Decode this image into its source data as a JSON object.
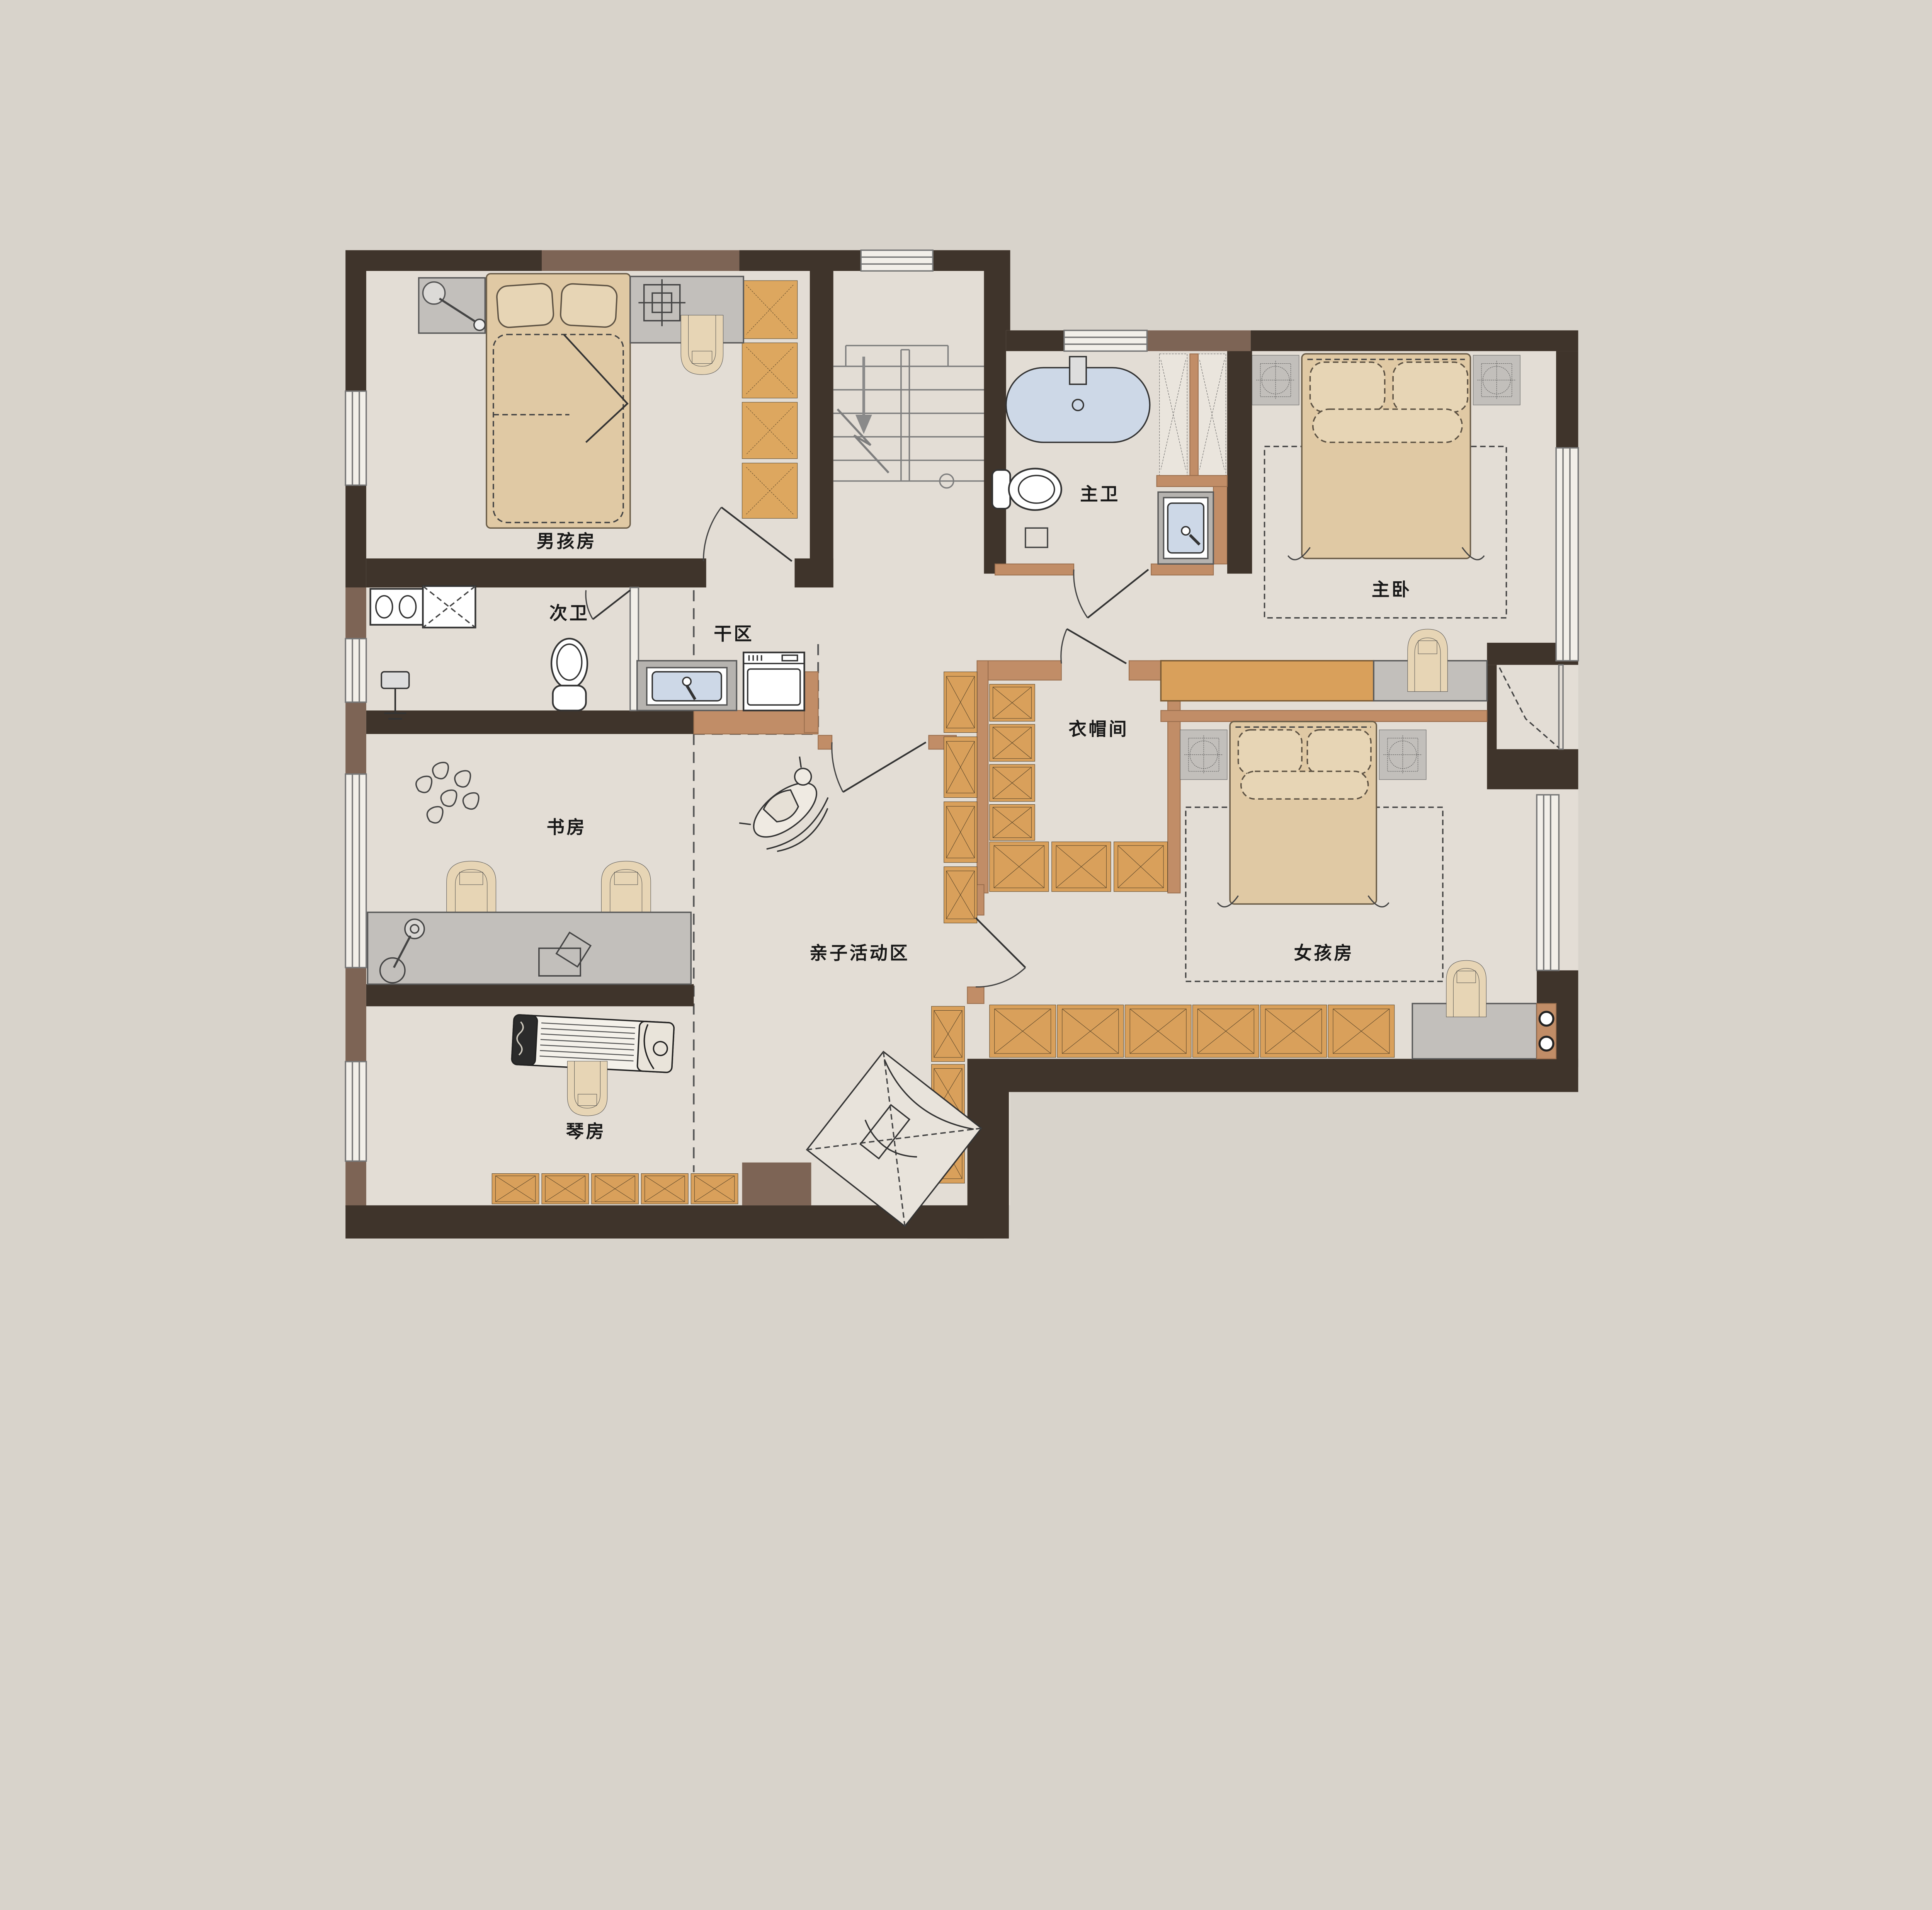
{
  "floorplan": {
    "title": "二层平面布置图",
    "rooms": {
      "boy_room": {
        "label": "男孩房"
      },
      "secondary_bath": {
        "label": "次卫"
      },
      "dry_area": {
        "label": "干区"
      },
      "master_bath": {
        "label": "主卫"
      },
      "master_bedroom": {
        "label": "主卧"
      },
      "walk_in_closet": {
        "label": "衣帽间"
      },
      "study": {
        "label": "书房"
      },
      "activity_area": {
        "label": "亲子活动区"
      },
      "girl_room": {
        "label": "女孩房"
      },
      "piano_room": {
        "label": "琴房"
      }
    },
    "colors": {
      "background": "#d8d3cb",
      "floor": "#e3ddd5",
      "wall_dark": "#3f342b",
      "wall_brown": "#7d6455",
      "wall_tan": "#c18d67",
      "wardrobe_orange": "#d9a05b",
      "water_blue": "#cdd8e7",
      "furniture_gray": "#c2bfbb",
      "furniture_tan": "#e7d5b5"
    }
  }
}
